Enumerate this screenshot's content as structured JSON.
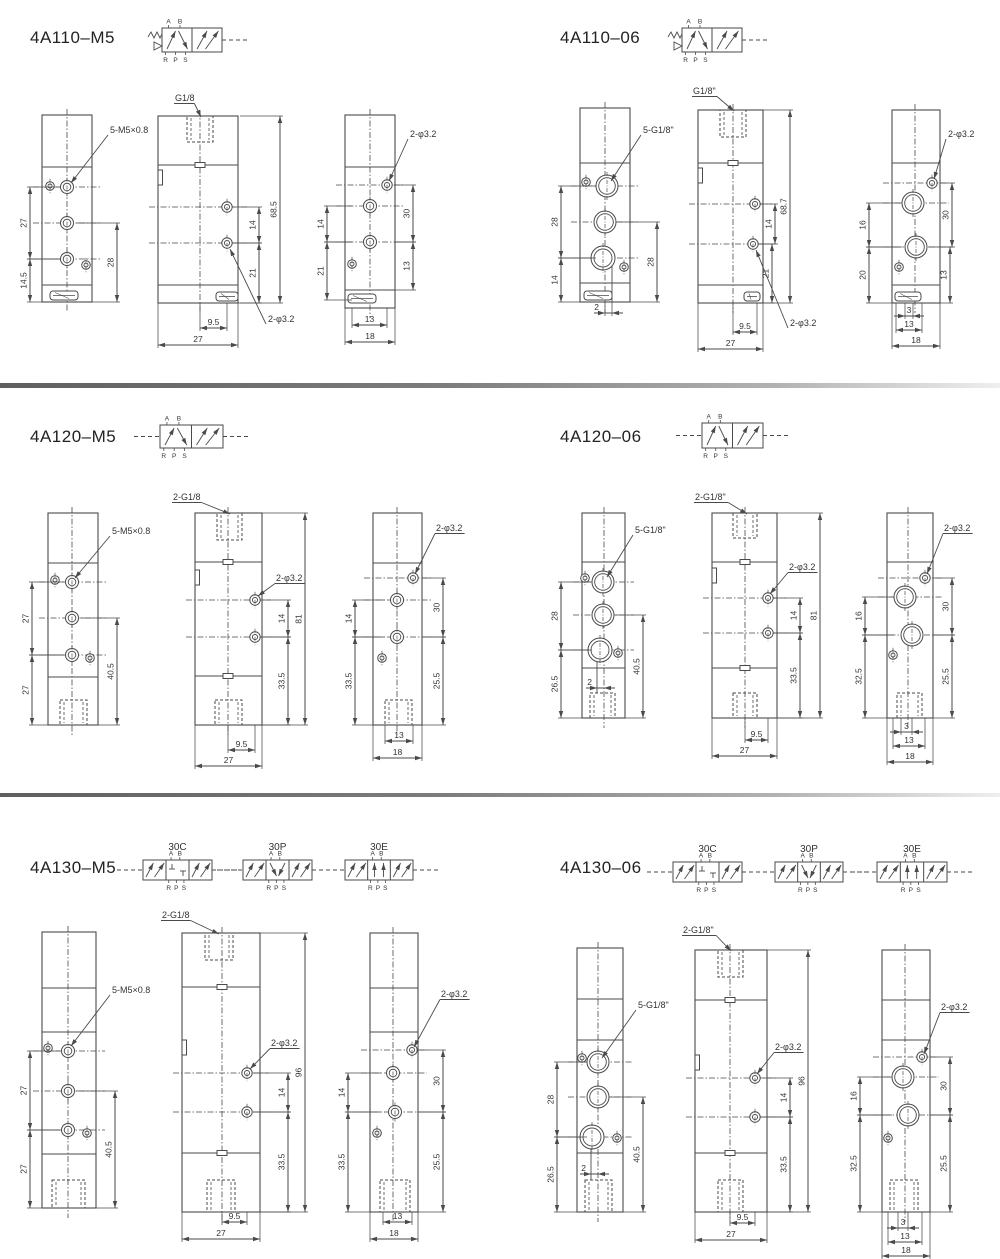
{
  "page": {
    "background": "#ffffff",
    "line_color": "#4a4a4a",
    "text_color": "#333333"
  },
  "panels": [
    {
      "id": "4a110-m5",
      "title": "4A110–M5",
      "symbol_ports": {
        "top": [
          "A",
          "B"
        ],
        "bottom": [
          "R",
          "P",
          "S"
        ]
      },
      "symbol_variants": [],
      "views": {
        "left": {
          "thread_leader": "5-M5×0.8",
          "dims_left": [
            "27",
            "14.5"
          ],
          "dims_right": [
            "28"
          ],
          "dims_bottom": []
        },
        "middle": {
          "port_leader": "G1/8",
          "dim_height": "68.5",
          "dims_inner": [
            "14",
            "21"
          ],
          "hole_leader": "2-φ3.2",
          "dims_bottom": [
            "9.5",
            "27"
          ]
        },
        "right": {
          "hole_leader": "2-φ3.2",
          "dims_left": [
            "14",
            "21"
          ],
          "dims_right": [
            "30",
            "13"
          ],
          "dims_bottom": [
            "13",
            "18"
          ]
        }
      }
    },
    {
      "id": "4a110-06",
      "title": "4A110–06",
      "symbol_ports": {
        "top": [
          "A",
          "B"
        ],
        "bottom": [
          "R",
          "P",
          "S"
        ]
      },
      "symbol_variants": [],
      "views": {
        "left": {
          "thread_leader": "5-G1/8\"",
          "dims_left": [
            "28",
            "14"
          ],
          "dims_right": [
            "28"
          ],
          "dims_bottom": [
            "2"
          ]
        },
        "middle": {
          "port_leader": "G1/8\"",
          "dim_height": "68.7",
          "dims_inner": [
            "14",
            "21"
          ],
          "hole_leader": "2-φ3.2",
          "dims_bottom": [
            "9.5",
            "27"
          ]
        },
        "right": {
          "hole_leader": "2-φ3.2",
          "dims_left": [
            "16",
            "20"
          ],
          "dims_right": [
            "30",
            "13"
          ],
          "dims_bottom": [
            "3",
            "13",
            "18"
          ]
        }
      }
    },
    {
      "id": "4a120-m5",
      "title": "4A120–M5",
      "symbol_ports": {
        "top": [
          "A",
          "B"
        ],
        "bottom": [
          "R",
          "P",
          "S"
        ]
      },
      "symbol_variants": [],
      "views": {
        "left": {
          "thread_leader": "5-M5×0.8",
          "dims_left": [
            "27",
            "27"
          ],
          "dims_right": [
            "40.5"
          ],
          "dims_bottom": []
        },
        "middle": {
          "port_leader": "2-G1/8",
          "dim_height": "81",
          "dims_inner": [
            "14",
            "33.5"
          ],
          "hole_leader": "2-φ3.2",
          "dims_bottom": [
            "9.5",
            "27"
          ]
        },
        "right": {
          "hole_leader": "2-φ3.2",
          "dims_left": [
            "14",
            "33.5"
          ],
          "dims_right": [
            "30",
            "25.5"
          ],
          "dims_bottom": [
            "13",
            "18"
          ]
        }
      }
    },
    {
      "id": "4a120-06",
      "title": "4A120–06",
      "symbol_ports": {
        "top": [
          "A",
          "B"
        ],
        "bottom": [
          "R",
          "P",
          "S"
        ]
      },
      "symbol_variants": [],
      "views": {
        "left": {
          "thread_leader": "5-G1/8\"",
          "dims_left": [
            "28",
            "26.5"
          ],
          "dims_right": [
            "40.5"
          ],
          "dims_bottom": [
            "2"
          ]
        },
        "middle": {
          "port_leader": "2-G1/8\"",
          "dim_height": "81",
          "dims_inner": [
            "14",
            "33.5"
          ],
          "hole_leader": "2-φ3.2",
          "dims_bottom": [
            "9.5",
            "27"
          ]
        },
        "right": {
          "hole_leader": "2-φ3.2",
          "dims_left": [
            "16",
            "32.5"
          ],
          "dims_right": [
            "30",
            "25.5"
          ],
          "dims_bottom": [
            "3",
            "13",
            "18"
          ]
        }
      }
    },
    {
      "id": "4a130-m5",
      "title": "4A130–M5",
      "symbol_ports": {
        "top": [
          "A",
          "B"
        ],
        "bottom": [
          "R",
          "P",
          "S"
        ]
      },
      "symbol_variants": [
        "30C",
        "30P",
        "30E"
      ],
      "views": {
        "left": {
          "thread_leader": "5-M5×0.8",
          "dims_left": [
            "27",
            "27"
          ],
          "dims_right": [
            "40.5"
          ],
          "dims_bottom": []
        },
        "middle": {
          "port_leader": "2-G1/8",
          "dim_height": "96",
          "dims_inner": [
            "14",
            "33.5"
          ],
          "hole_leader": "2-φ3.2",
          "dims_bottom": [
            "9.5",
            "27"
          ]
        },
        "right": {
          "hole_leader": "2-φ3.2",
          "dims_left": [
            "14",
            "33.5"
          ],
          "dims_right": [
            "30",
            "25.5"
          ],
          "dims_bottom": [
            "13",
            "18"
          ]
        }
      }
    },
    {
      "id": "4a130-06",
      "title": "4A130–06",
      "symbol_ports": {
        "top": [
          "A",
          "B"
        ],
        "bottom": [
          "R",
          "P",
          "S"
        ]
      },
      "symbol_variants": [
        "30C",
        "30P",
        "30E"
      ],
      "views": {
        "left": {
          "thread_leader": "5-G1/8\"",
          "dims_left": [
            "28",
            "26.5"
          ],
          "dims_right": [
            "40.5"
          ],
          "dims_bottom": [
            "2"
          ]
        },
        "middle": {
          "port_leader": "2-G1/8\"",
          "dim_height": "96",
          "dims_inner": [
            "14",
            "33.5"
          ],
          "hole_leader": "2-φ3.2",
          "dims_bottom": [
            "9.5",
            "27"
          ]
        },
        "right": {
          "hole_leader": "2-φ3.2",
          "dims_left": [
            "16",
            "32.5"
          ],
          "dims_right": [
            "30",
            "25.5"
          ],
          "dims_bottom": [
            "3",
            "13",
            "18"
          ]
        }
      }
    }
  ]
}
